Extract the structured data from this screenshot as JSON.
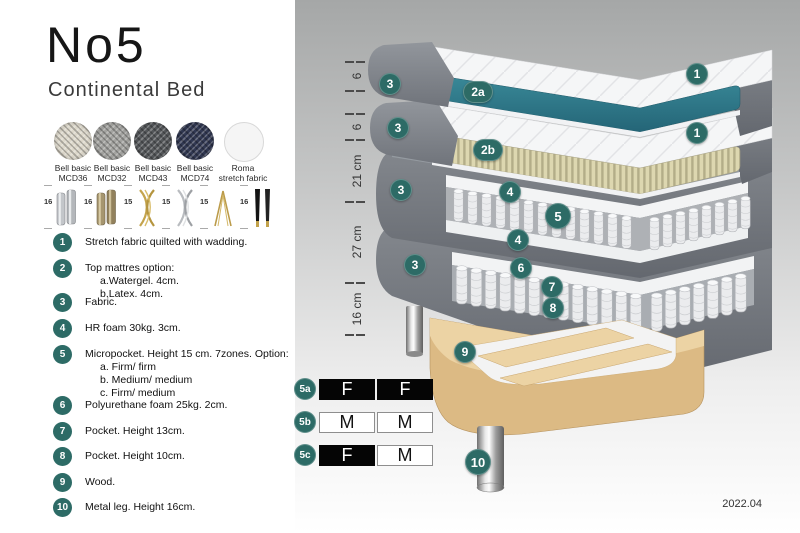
{
  "header": {
    "title": "No5",
    "subtitle": "Continental Bed"
  },
  "swatches": [
    {
      "line1": "Bell basic",
      "line2": "MCD36",
      "color": "#ddd8cb"
    },
    {
      "line1": "Bell basic",
      "line2": "MCD32",
      "color": "#a3a3a0"
    },
    {
      "line1": "Bell basic",
      "line2": "MCD43",
      "color": "#54575a"
    },
    {
      "line1": "Bell basic",
      "line2": "MCD74",
      "color": "#313852"
    },
    {
      "line1": "Roma",
      "line2": "stretch fabric",
      "color": "#f5f5f5"
    }
  ],
  "legs": [
    {
      "height": "16",
      "name": "chrome-cylinder-leg"
    },
    {
      "height": "16",
      "name": "bronze-cylinder-leg"
    },
    {
      "height": "15",
      "name": "gold-curved-cross-leg"
    },
    {
      "height": "15",
      "name": "silver-curved-cross-leg"
    },
    {
      "height": "15",
      "name": "gold-hairpin-leg"
    },
    {
      "height": "16",
      "name": "black-gold-tip-leg"
    }
  ],
  "features": [
    {
      "num": "1",
      "text": "Stretch fabric quilted with wadding.",
      "subs": []
    },
    {
      "num": "2",
      "text": "Top mattres option:",
      "subs": [
        "a.Watergel. 4cm.",
        "b.Latex. 4cm."
      ]
    },
    {
      "num": "3",
      "text": "Fabric.",
      "subs": []
    },
    {
      "num": "4",
      "text": "HR foam 30kg. 3cm.",
      "subs": []
    },
    {
      "num": "5",
      "text": "Micropocket. Height 15 cm. 7zones. Option:",
      "subs": [
        "a. Firm/ firm",
        "b. Medium/ medium",
        "c. Firm/ medium"
      ]
    },
    {
      "num": "6",
      "text": "Polyurethane foam 25kg. 2cm.",
      "subs": []
    },
    {
      "num": "7",
      "text": "Pocket. Height 13cm.",
      "subs": []
    },
    {
      "num": "8",
      "text": "Pocket. Height 10cm.",
      "subs": []
    },
    {
      "num": "9",
      "text": "Wood.",
      "subs": []
    },
    {
      "num": "10",
      "text": "Metal leg. Height 16cm.",
      "subs": []
    }
  ],
  "ruler": {
    "labels": [
      "6",
      "6",
      "21 cm",
      "27 cm",
      "16 cm"
    ]
  },
  "badges": [
    "3",
    "2a",
    "1",
    "3",
    "2b",
    "1",
    "4",
    "5",
    "3",
    "4",
    "6",
    "7",
    "3",
    "8",
    "9",
    "10"
  ],
  "firmness": {
    "rows": [
      {
        "label": "5a",
        "cells": [
          {
            "letter": "F",
            "style": "dark"
          },
          {
            "letter": "F",
            "style": "dark"
          }
        ]
      },
      {
        "label": "5b",
        "cells": [
          {
            "letter": "M",
            "style": "light"
          },
          {
            "letter": "M",
            "style": "light"
          }
        ]
      },
      {
        "label": "5c",
        "cells": [
          {
            "letter": "F",
            "style": "dark"
          },
          {
            "letter": "M",
            "style": "light"
          }
        ]
      }
    ]
  },
  "version": "2022.04",
  "colors": {
    "badge_teal": "#2d6b66",
    "watergel_teal": "#2f7e90",
    "latex_cream": "#ddd7b0",
    "fabric_grey": "#75797f",
    "wood": "#e8cd9c",
    "panel_grey_top": "#a5a7a7"
  }
}
